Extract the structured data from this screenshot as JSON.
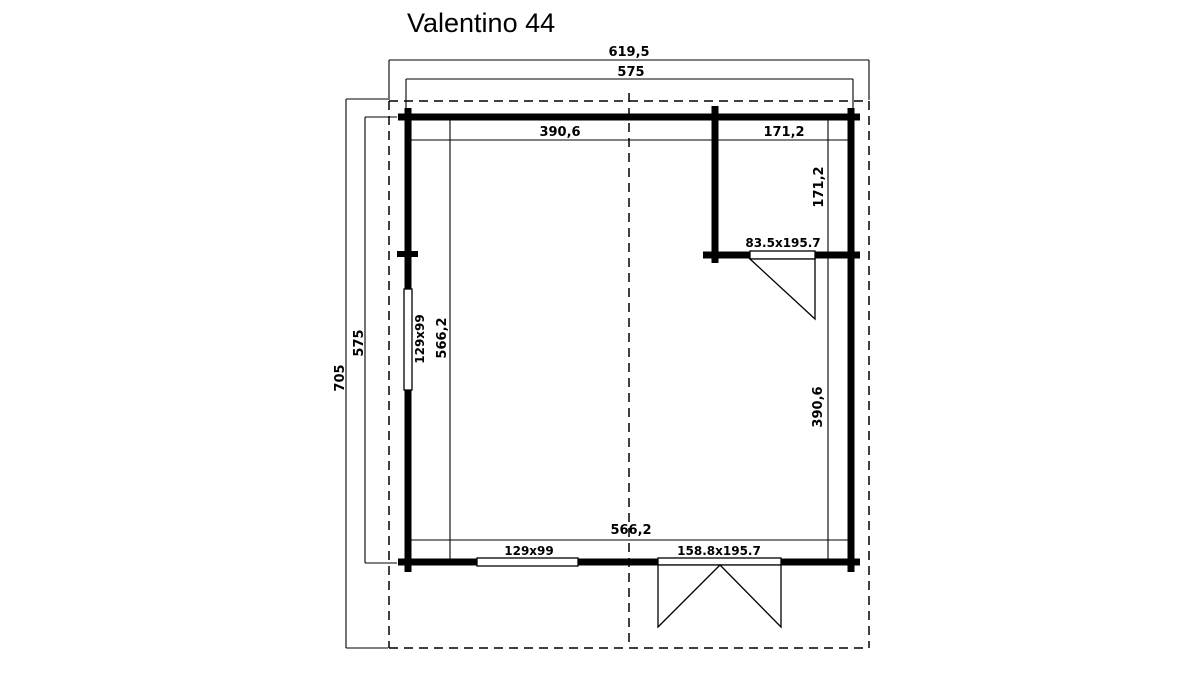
{
  "title": "Valentino 44",
  "colors": {
    "line": "#000000",
    "background": "#ffffff"
  },
  "dimensions": {
    "overall_width": "619,5",
    "exterior_width": "575",
    "overall_depth": "705",
    "exterior_depth": "575",
    "interior": {
      "main_width_top": "390,6",
      "annex_width_top": "171,2",
      "annex_depth_right": "171,2",
      "main_depth_right": "390,6",
      "interior_depth_left": "566,2",
      "interior_width_bottom": "566,2"
    }
  },
  "openings": {
    "left_window": "129x99",
    "bottom_window": "129x99",
    "interior_door": "83.5x195.7",
    "front_double_door": "158.8x195.7"
  }
}
